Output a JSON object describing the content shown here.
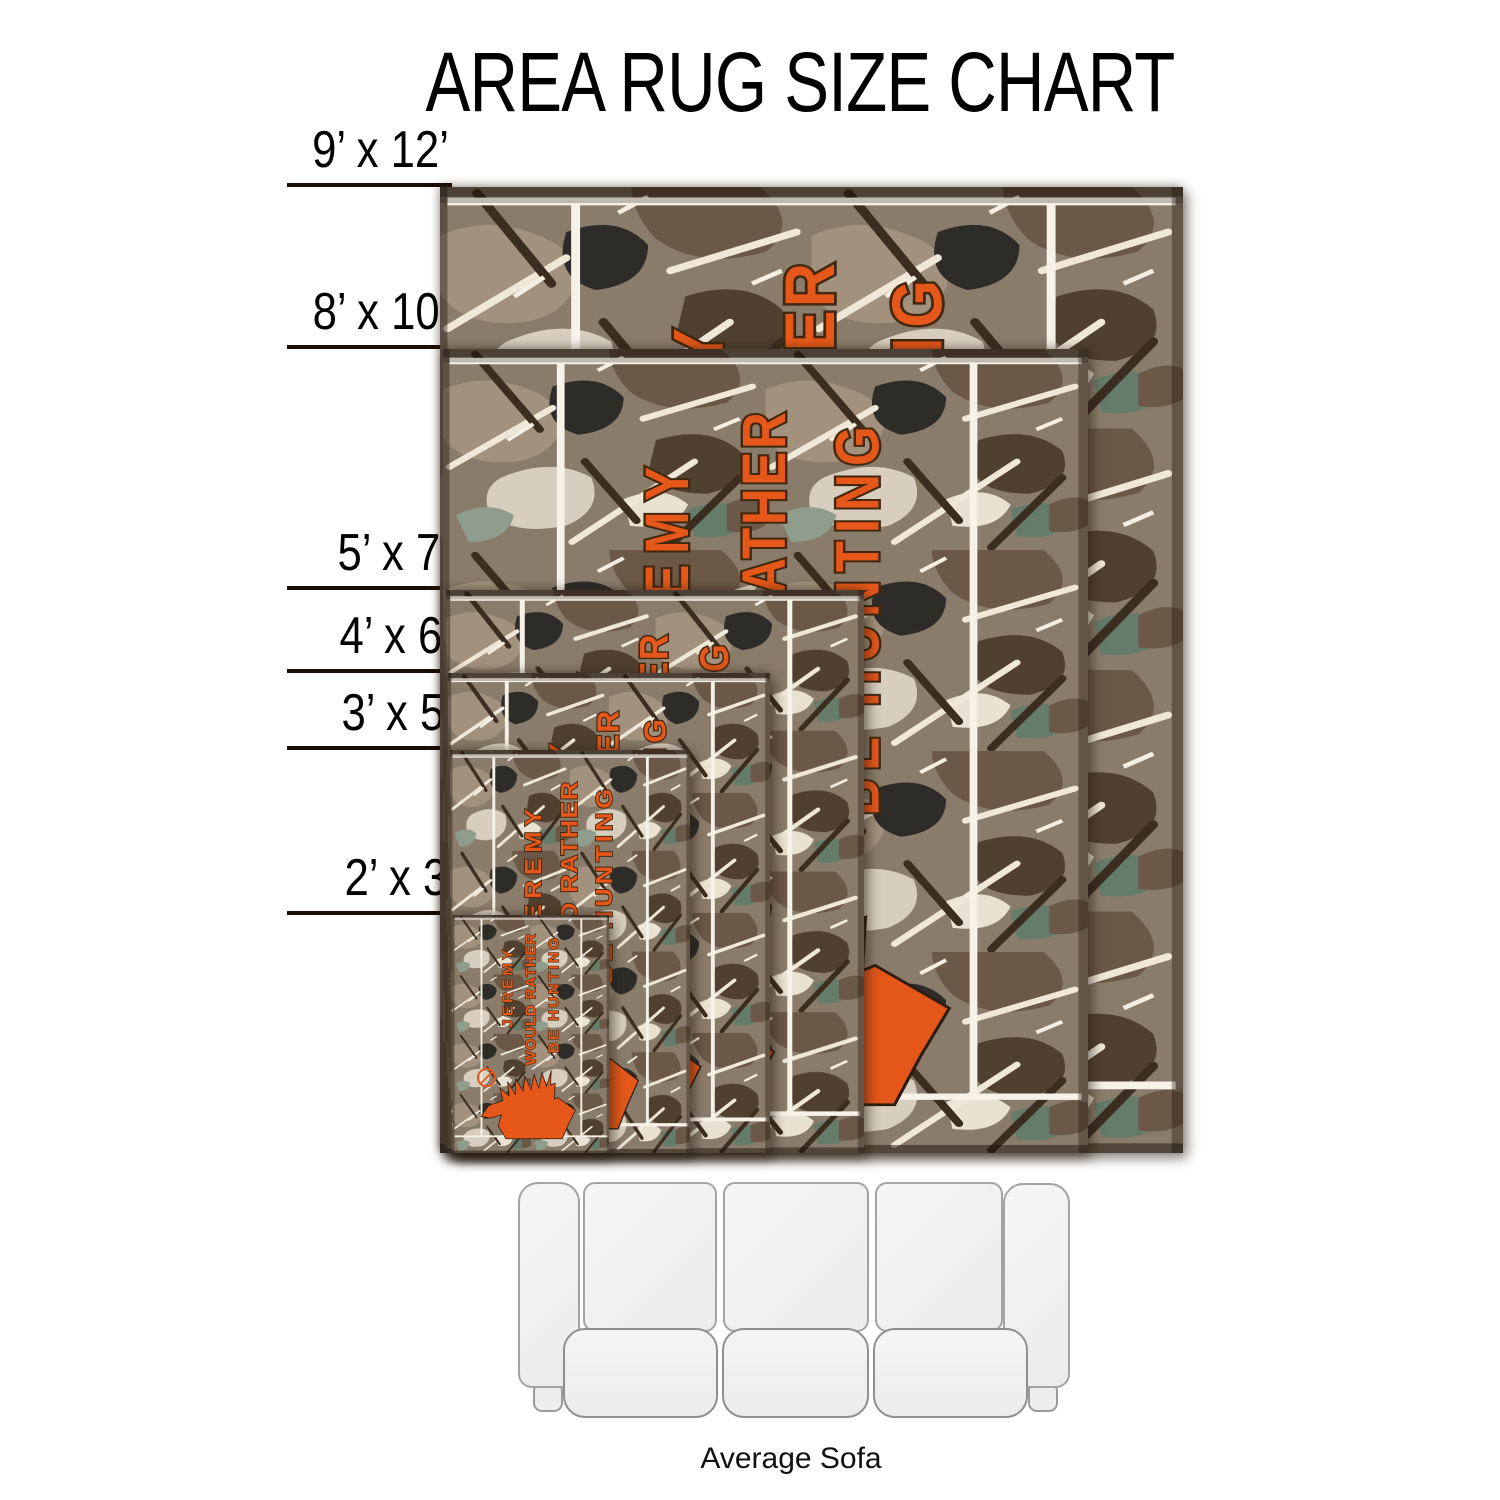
{
  "title": "AREA RUG SIZE CHART",
  "rug_sizes": [
    {
      "label": "9’ x 12’",
      "width_ft": 9,
      "length_ft": 12
    },
    {
      "label": "8’ x 10’",
      "width_ft": 8,
      "length_ft": 10
    },
    {
      "label": "5’ x 7’",
      "width_ft": 5,
      "length_ft": 7
    },
    {
      "label": "4’ x 6’",
      "width_ft": 4,
      "length_ft": 6
    },
    {
      "label": "3’ x 5’",
      "width_ft": 3,
      "length_ft": 5
    },
    {
      "label": "2’ x 3’",
      "width_ft": 2,
      "length_ft": 3
    }
  ],
  "rug_design": {
    "text_line1": "JEREMY",
    "text_line2": "WOULD RATHER",
    "text_line3": "BE HUNTING",
    "text_color": "#e5581a",
    "pattern": "woodland-camouflage",
    "emblem": "deer-head-silhouette-with-scope-circle"
  },
  "sofa": {
    "label": "Average Sofa"
  },
  "colors": {
    "background": "#ffffff",
    "title_text": "#000000",
    "size_line": "#1e0d05",
    "rug_text_orange": "#e5581a",
    "rug_text_outline": "#43280f",
    "white_stripe": "#f6f2e8",
    "sofa_fill": "#f1f1f1",
    "sofa_outline": "#9e9e9e",
    "camo_palette": [
      "#8a7c6b",
      "#a2917d",
      "#6b5846",
      "#d7cebf",
      "#50402f",
      "#2d2c29",
      "#8e9d8c",
      "#657c6b",
      "#e9e1d1",
      "#efe8d9",
      "#3b2d20"
    ]
  }
}
